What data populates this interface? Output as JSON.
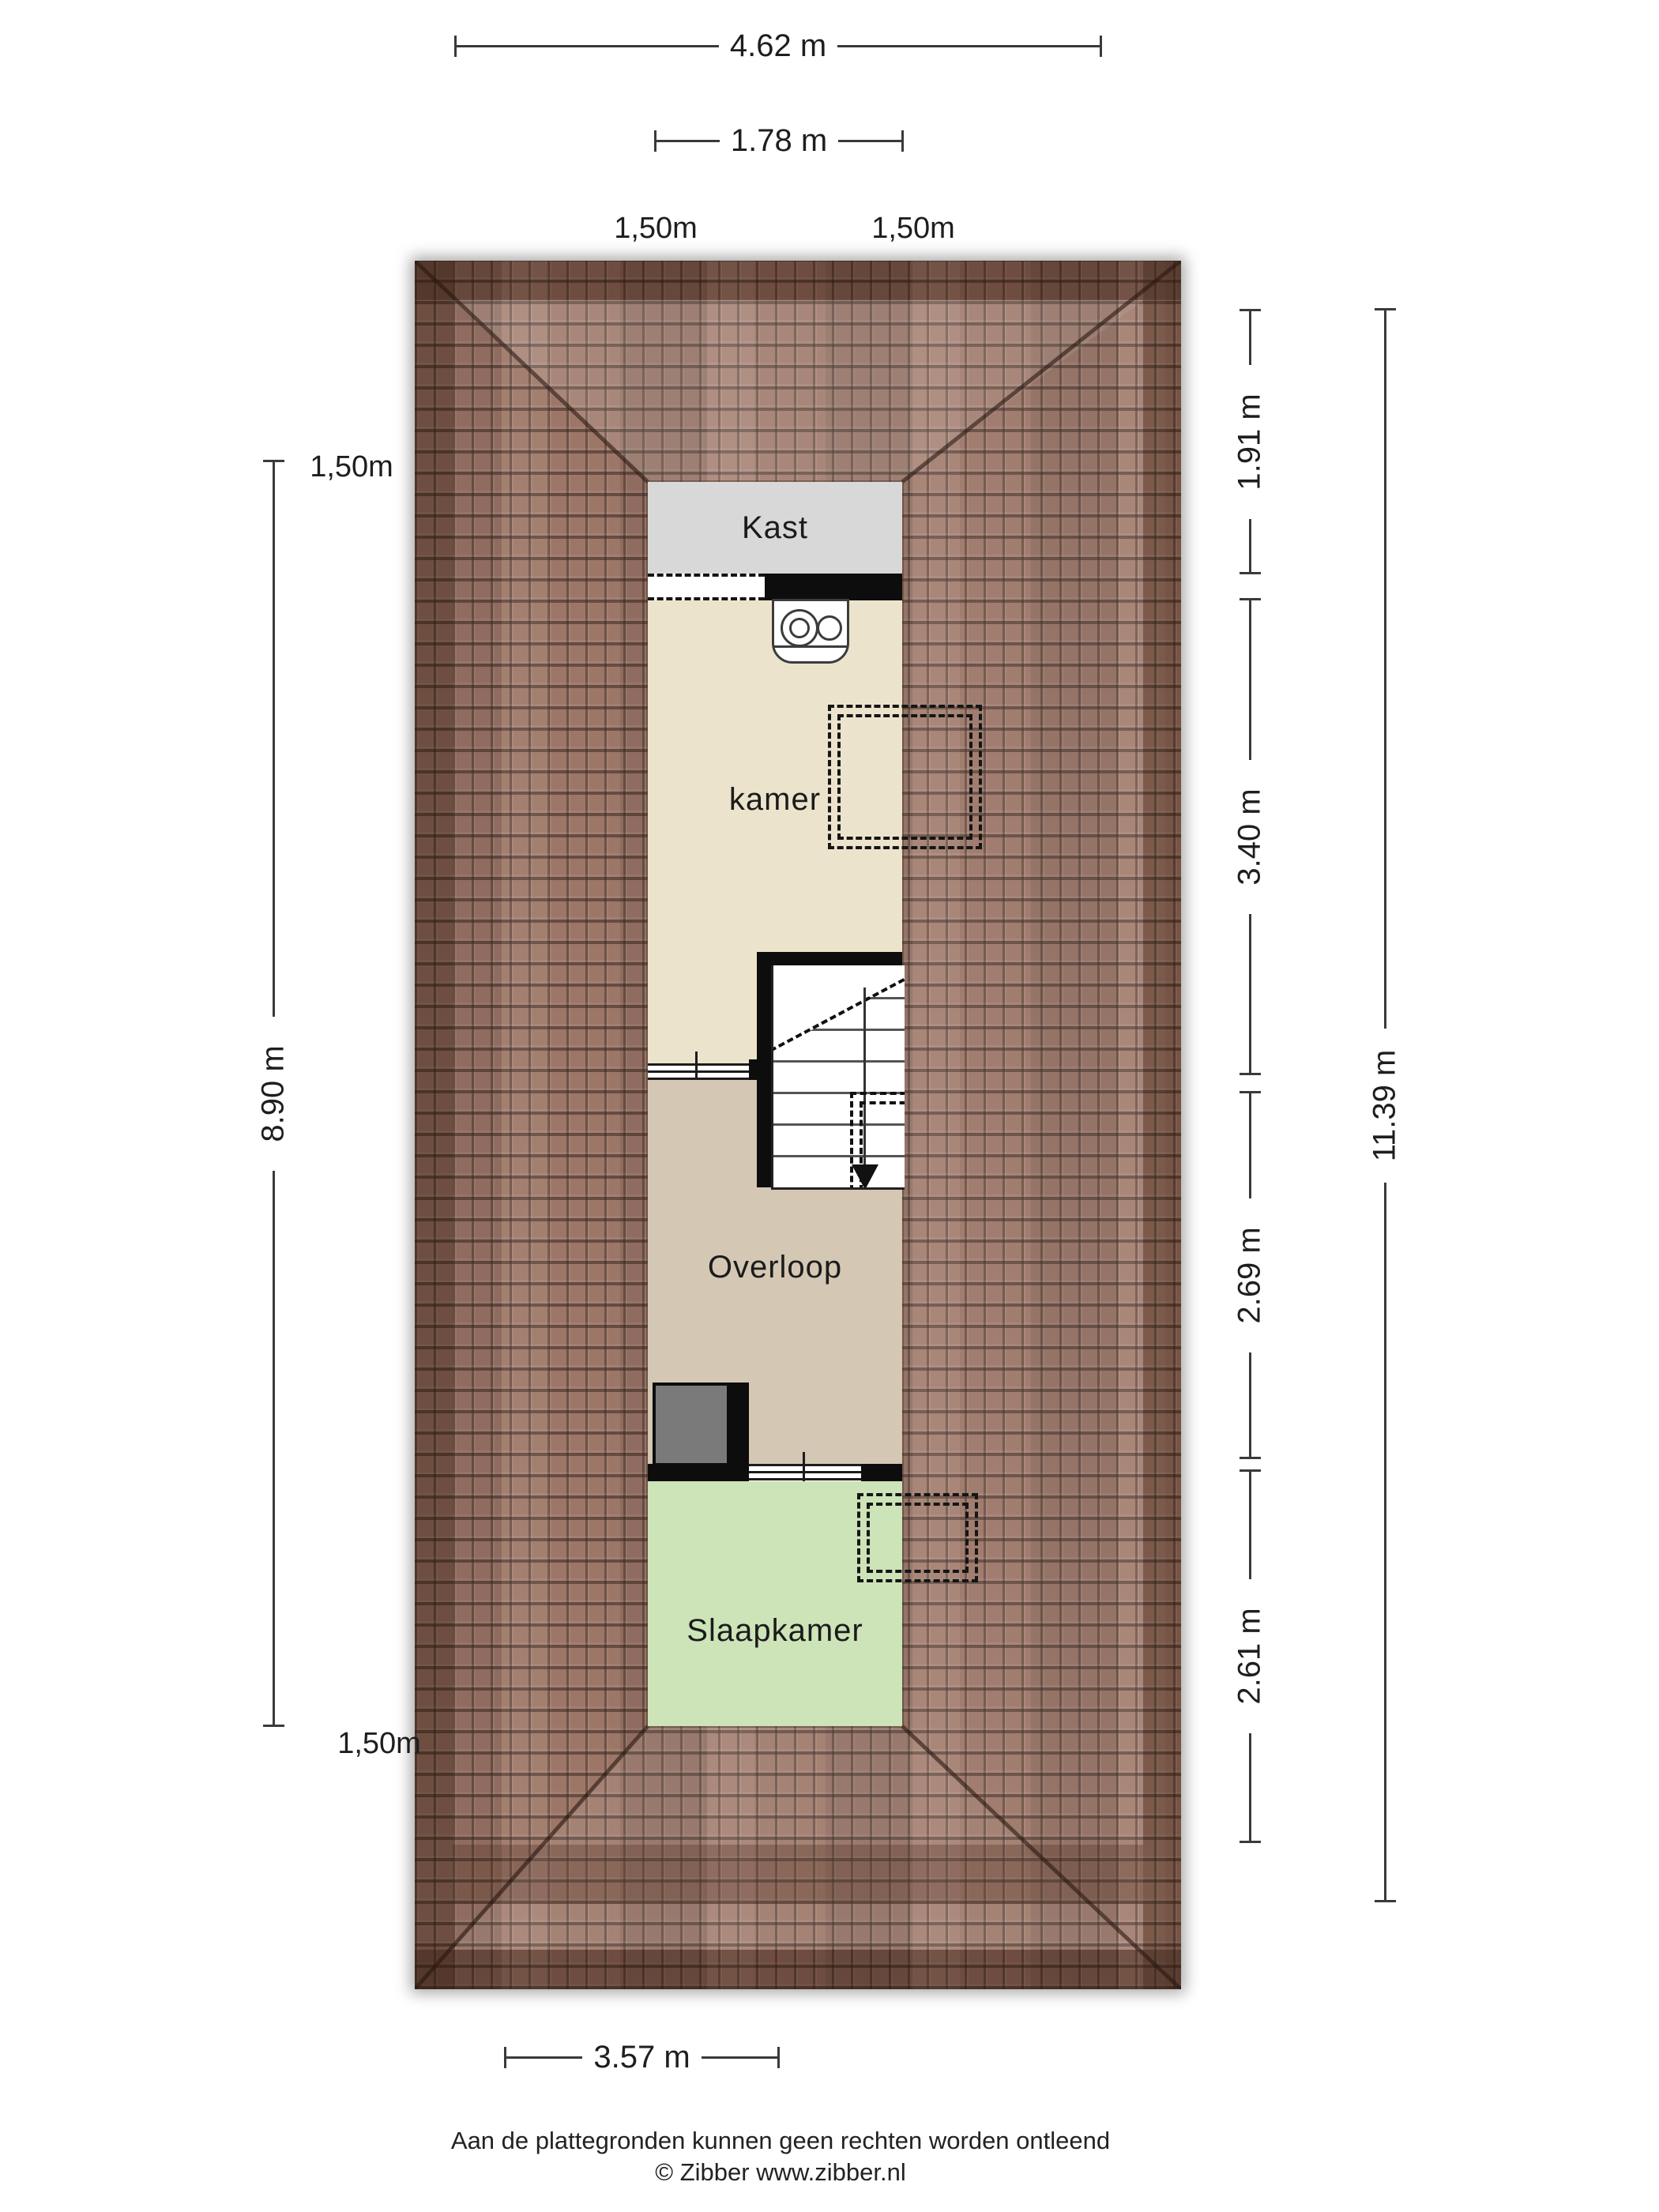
{
  "plan": {
    "type": "attic floor plan",
    "rooms": [
      {
        "name": "Kast"
      },
      {
        "name": "kamer"
      },
      {
        "name": "Overloop"
      },
      {
        "name": "Slaapkamer"
      }
    ]
  },
  "dimensions": {
    "top_width": "4.62 m",
    "top_dormer_width": "1.78 m",
    "clearance_top_left": "1,50m",
    "clearance_top_right": "1,50m",
    "left_clearance_top": "1,50m",
    "left_height": "8.90 m",
    "left_clearance_bottom": "1,50m",
    "right_segments": [
      {
        "label": "1.91 m"
      },
      {
        "label": "3.40 m"
      },
      {
        "label": "2.69 m"
      },
      {
        "label": "2.61 m"
      }
    ],
    "right_total": "11.39 m",
    "bottom_width": "3.57 m"
  },
  "footer": {
    "line1": "Aan de plattegronden kunnen geen rechten worden ontleend",
    "line2": "© Zibber www.zibber.nl"
  },
  "colors": {
    "roof_tile": "#9b7363",
    "roof_edge": "#5a4034",
    "kast": "#d8d8d8",
    "kamer": "#ebe3cc",
    "overloop": "#d4c7b4",
    "slaapkamer": "#cde3b8",
    "shaft": "#7a7a7a",
    "wall": "#0d0d0d",
    "dimension_line": "#3a3a3a"
  },
  "icons": {
    "boiler": "boiler-unit",
    "stairs": "staircase-down-arrow"
  }
}
